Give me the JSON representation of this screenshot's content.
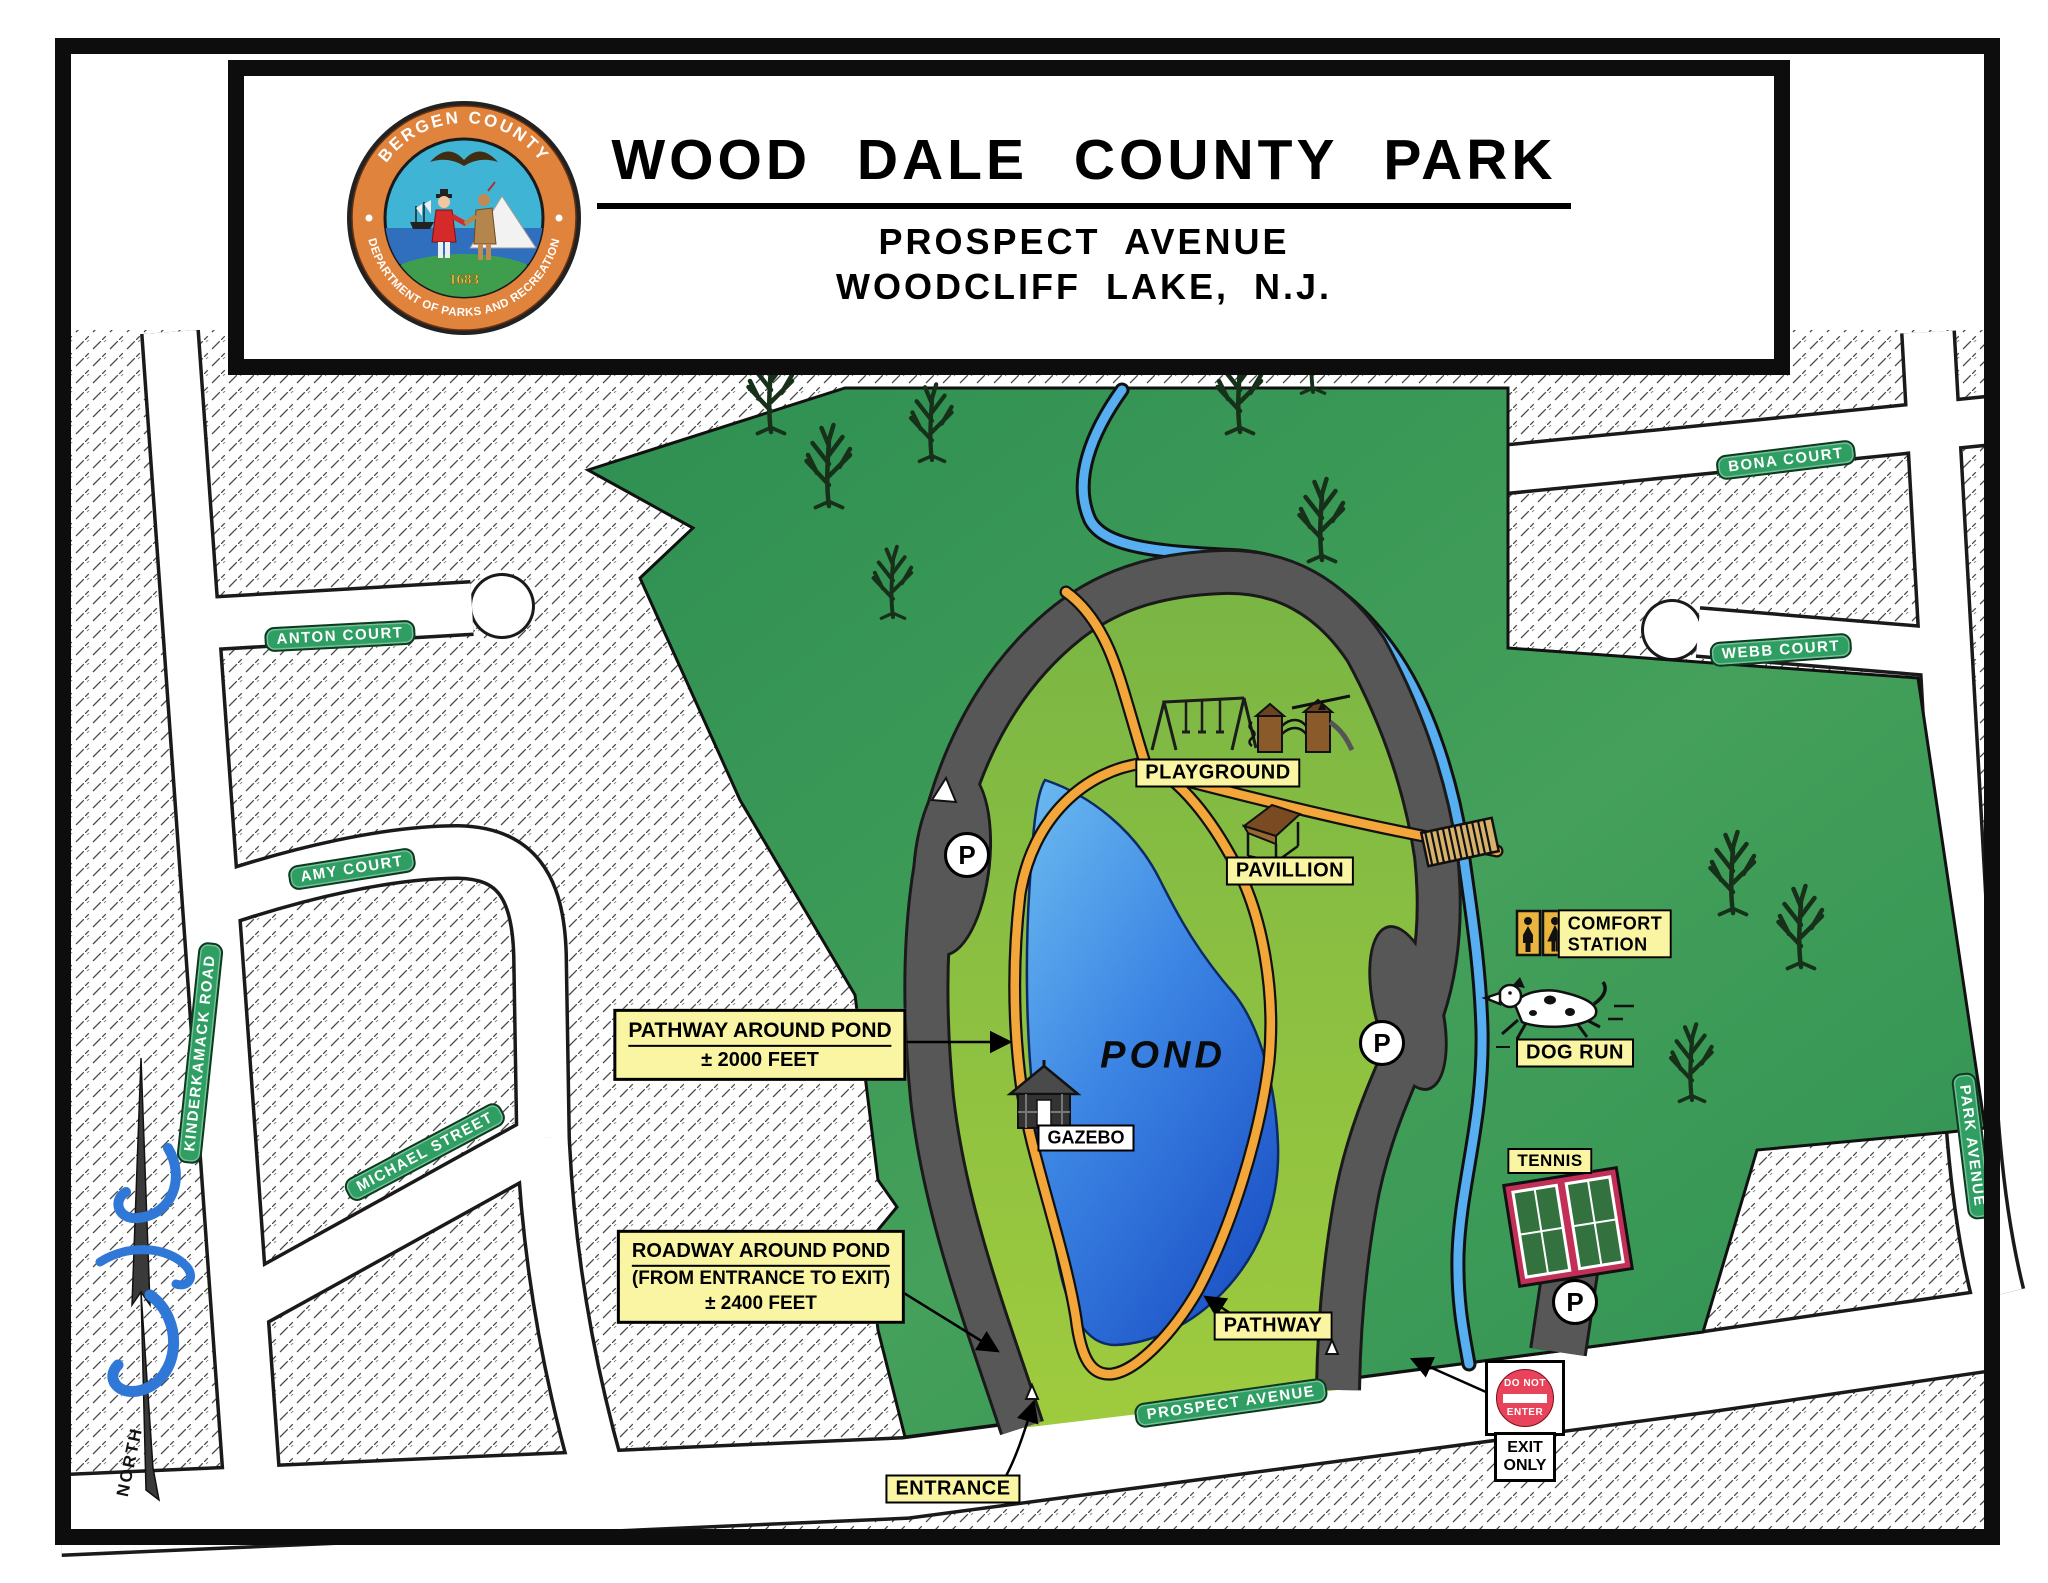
{
  "title_block": {
    "title": "WOOD DALE COUNTY PARK",
    "address_line1": "PROSPECT AVENUE",
    "address_line2": "WOODCLIFF LAKE, N.J.",
    "seal": {
      "arc_top": "BERGEN COUNTY",
      "arc_bottom": "DEPARTMENT OF PARKS AND RECREATION",
      "year": "1683"
    }
  },
  "streets": {
    "anton": "ANTON COURT",
    "amy": "AMY COURT",
    "kinderkamack": "KINDERKAMACK ROAD",
    "michael": "MICHAEL STREET",
    "bona": "BONA COURT",
    "webb": "WEBB COURT",
    "park_avenue": "PARK AVENUE",
    "prospect": "PROSPECT AVENUE"
  },
  "features": {
    "playground": "PLAYGROUND",
    "pavillion": "PAVILLION",
    "comfort_line1": "COMFORT",
    "comfort_line2": "STATION",
    "dog_run": "DOG RUN",
    "tennis": "TENNIS",
    "gazebo": "GAZEBO",
    "pond": "POND",
    "pathway": "PATHWAY",
    "entrance": "ENTRANCE"
  },
  "callouts": {
    "pathway_pond": {
      "line1": "PATHWAY AROUND POND",
      "line2": "± 2000 FEET"
    },
    "roadway_pond": {
      "line1": "ROADWAY AROUND POND",
      "line2": "(FROM ENTRANCE TO EXIT)",
      "line3": "± 2400 FEET"
    }
  },
  "signs": {
    "do_not": "DO NOT",
    "enter": "ENTER",
    "exit": "EXIT",
    "only": "ONLY"
  },
  "markers": {
    "parking": "P",
    "north": "NORTH"
  },
  "colors": {
    "park_green": "#3f9e58",
    "loop_green": "#8cc043",
    "pond_blue": "#2e7bdf",
    "roadway_gray": "#575757",
    "pathway_orange": "#f3a63a",
    "stream_blue": "#57aef0",
    "street_sign_green": "#2f9e63",
    "label_yellow": "#f9f5a2",
    "stop_red": "#e8435a",
    "tennis_magenta": "#c23058",
    "seal_orange": "#e0833c"
  }
}
